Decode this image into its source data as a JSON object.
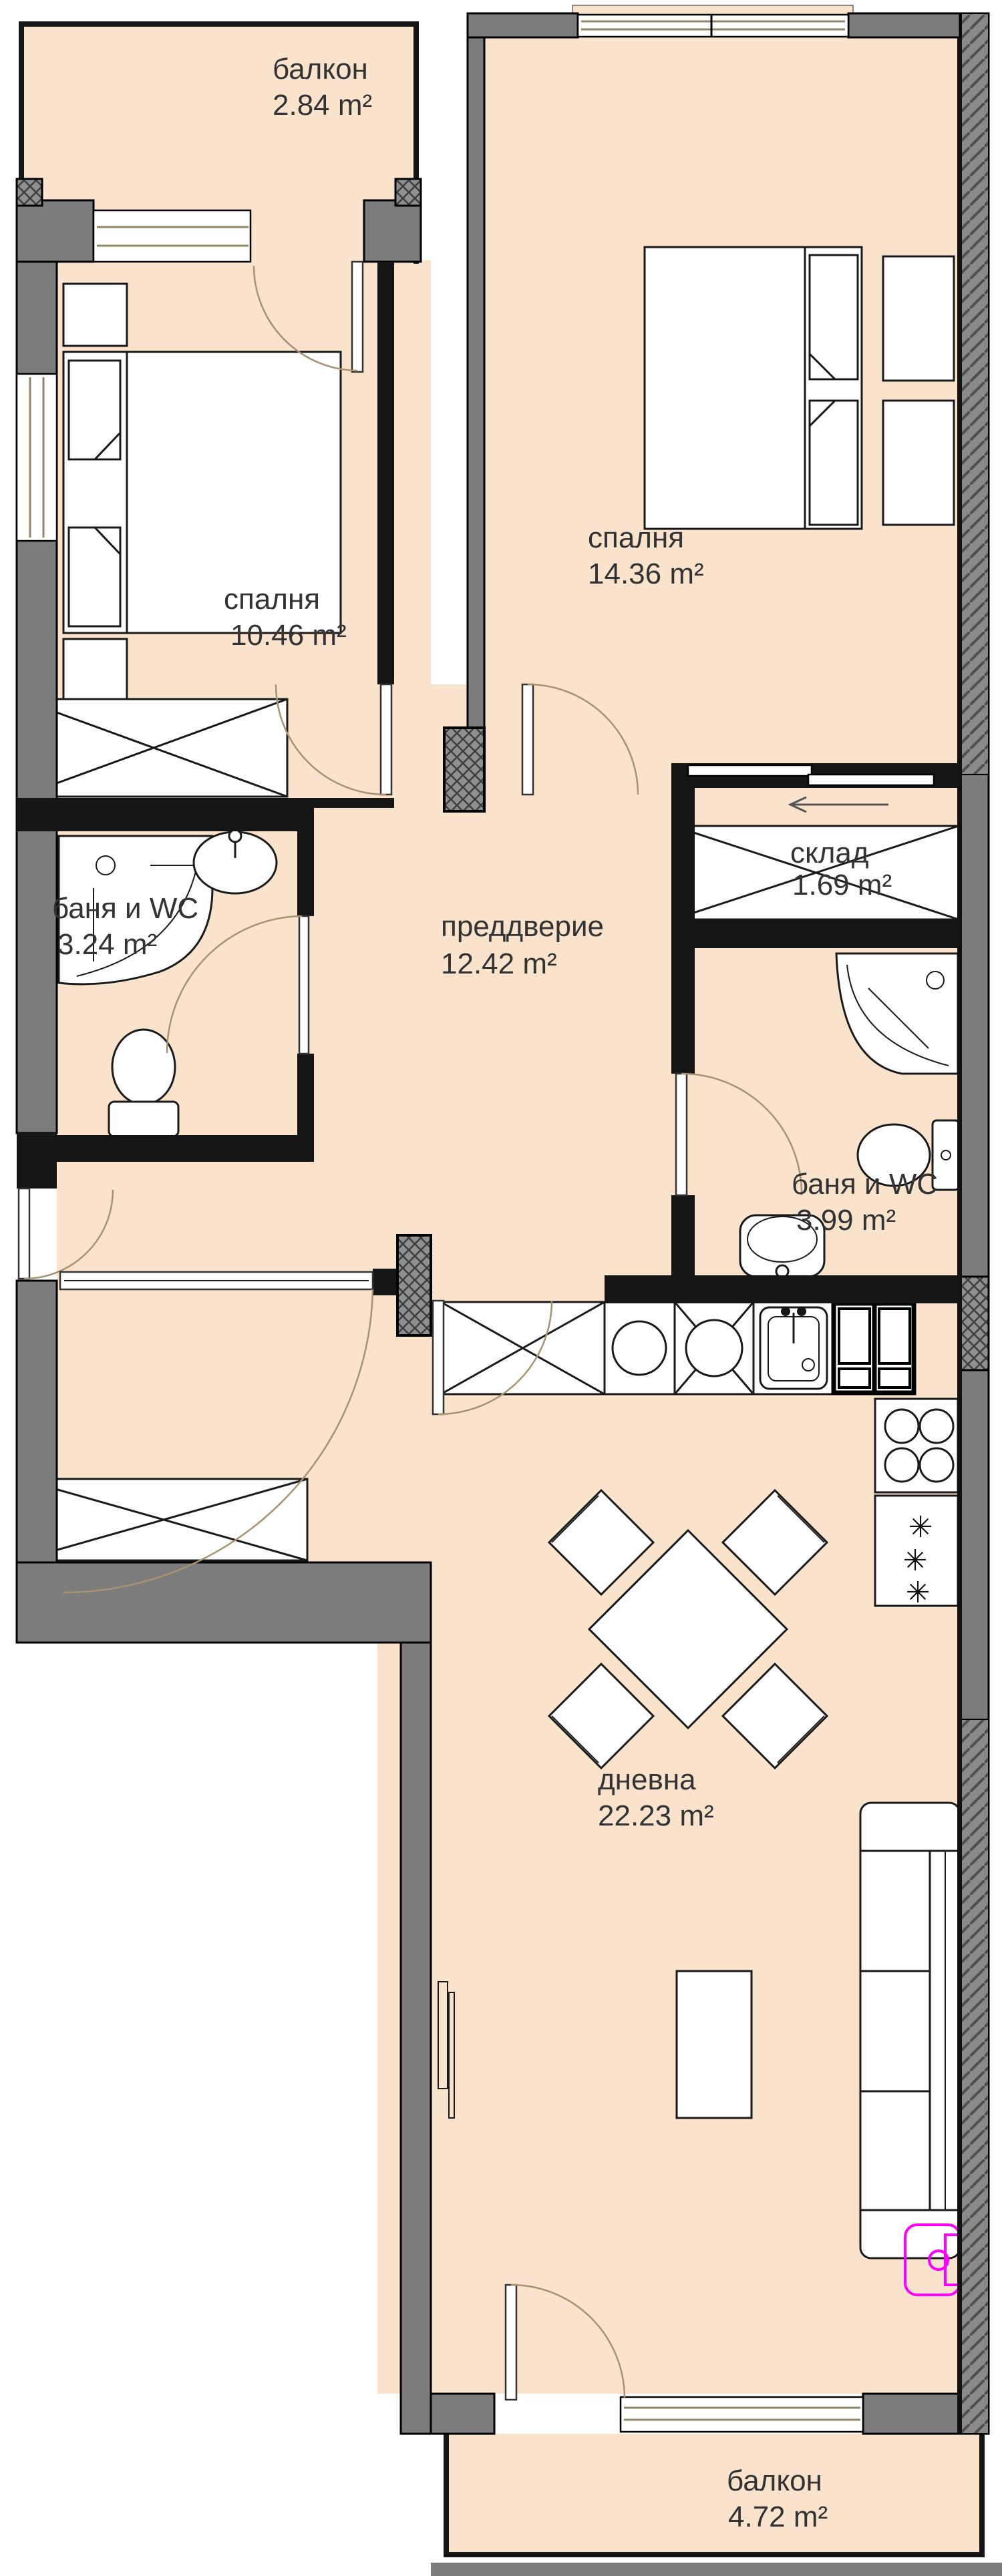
{
  "title": "апартамент план",
  "rooms": {
    "balcony_top": {
      "name": "балкон",
      "area": "2.84 m²"
    },
    "bedroom_right": {
      "name": "спалня",
      "area": "14.36 m²"
    },
    "bedroom_left": {
      "name": "спалня",
      "area": "10.46 m²"
    },
    "bath_left": {
      "name": "баня и WC",
      "area": "3.24 m²"
    },
    "hallway": {
      "name": "преддверие",
      "area": "12.42 m²"
    },
    "storage": {
      "name": "склад",
      "area": "1.69 m²"
    },
    "bath_right": {
      "name": "баня и WC",
      "area": "3.99 m²"
    },
    "living": {
      "name": "дневна",
      "area": "22.23 m²"
    },
    "balcony_bottom": {
      "name": "балкон",
      "area": "4.72 m²"
    }
  },
  "symbols": {
    "star": "✳"
  },
  "colors": {
    "floor": "#fae3cd",
    "wall": "#7c7c7c",
    "wallDark": "#151515",
    "line": "#1a1a1a",
    "frame": "#8f8568",
    "arc": "#a89274",
    "accent": "#ff00ff",
    "text": "#333333"
  }
}
